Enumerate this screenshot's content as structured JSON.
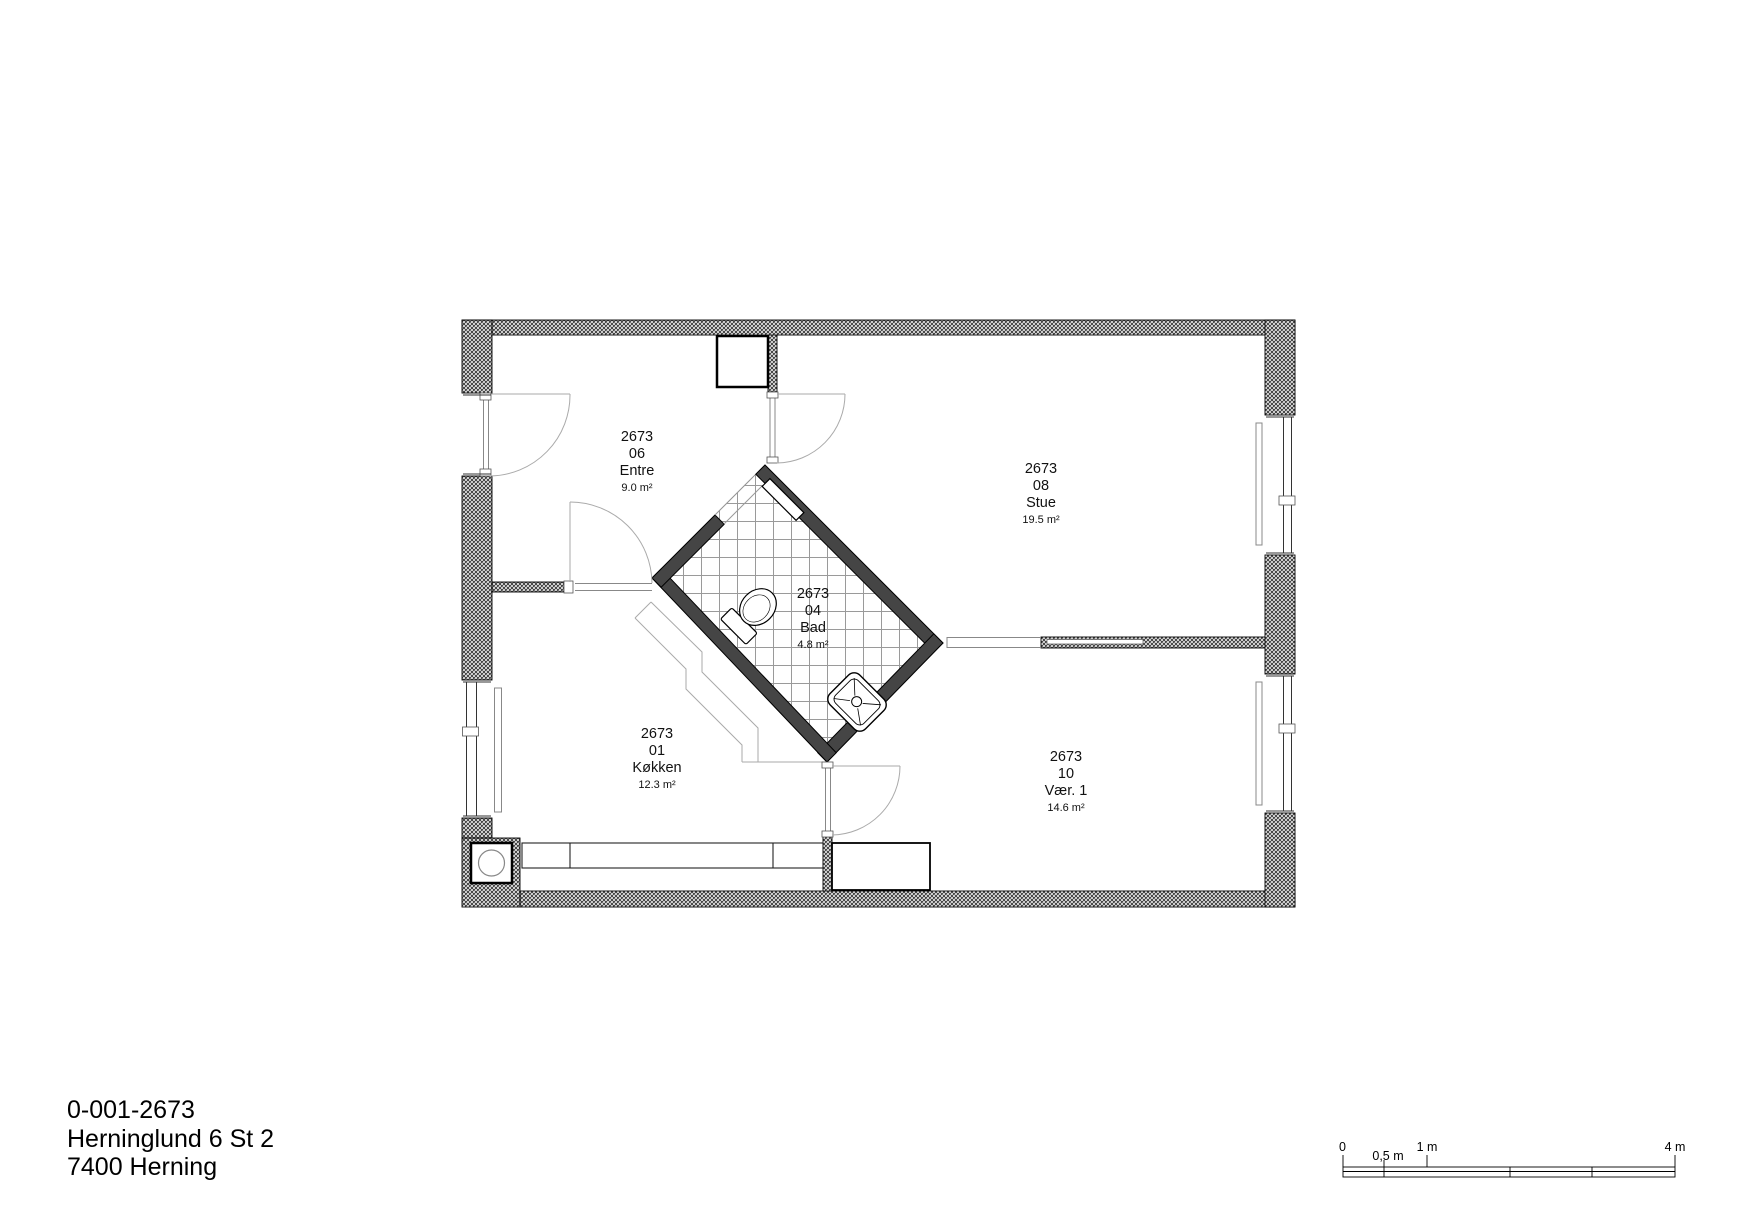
{
  "document": {
    "type": "architectural-floor-plan"
  },
  "title_block": {
    "plan_id": "0-001-2673",
    "address_line1": "Herninglund 6 St 2",
    "address_line2": "7400 Herning"
  },
  "rooms": [
    {
      "project": "2673",
      "number": "06",
      "name": "Entre",
      "area": "9.0 m²"
    },
    {
      "project": "2673",
      "number": "08",
      "name": "Stue",
      "area": "19.5 m²"
    },
    {
      "project": "2673",
      "number": "04",
      "name": "Bad",
      "area": "4.8 m²"
    },
    {
      "project": "2673",
      "number": "01",
      "name": "Køkken",
      "area": "12.3 m²"
    },
    {
      "project": "2673",
      "number": "10",
      "name": "Vær. 1",
      "area": "14.6 m²"
    }
  ],
  "fixtures": [
    "toilet",
    "washbasin",
    "kitchen-counter",
    "wardrobe",
    "radiator",
    "floor-drain"
  ],
  "scale_bar": {
    "tick_labels": [
      "0",
      "0,5 m",
      "1 m",
      "4 m"
    ]
  },
  "colors": {
    "background": "#ffffff",
    "wall_hatch_line": "#3c3c3c",
    "bathroom_wall": "#454545",
    "outline": "#000000",
    "tile_grid": "#9a9a9a",
    "swing_line": "#aaaaaa"
  }
}
